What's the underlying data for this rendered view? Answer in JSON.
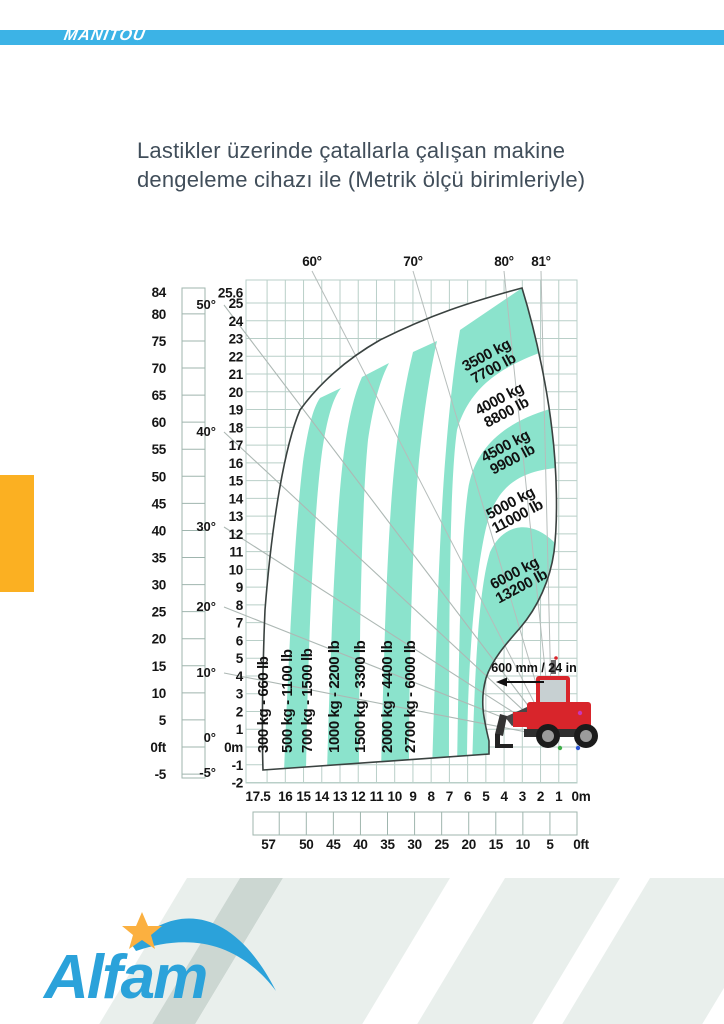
{
  "header": {
    "brand": "MANITOU",
    "bar_color": "#3cb3e6"
  },
  "title": {
    "line1": "Lastikler üzerinde çatallarla çalışan makine",
    "line2": "dengeleme cihazı ile (Metrik ölçü birimleriyle)"
  },
  "chart_data": {
    "type": "load-envelope-chart",
    "top_angle_labels": [
      "60°",
      "70°",
      "80°",
      "81°"
    ],
    "left_axis_ft": {
      "unit": "ft",
      "labels": [
        "84",
        "80",
        "75",
        "70",
        "65",
        "60",
        "55",
        "50",
        "45",
        "40",
        "35",
        "30",
        "25",
        "20",
        "15",
        "10",
        "5",
        "0ft",
        "-5"
      ]
    },
    "left_axis_angle": {
      "labels": [
        "50°",
        "40°",
        "30°",
        "20°",
        "10°",
        "0°",
        "-5°"
      ]
    },
    "left_axis_m": {
      "unit": "m",
      "labels": [
        "25.6",
        "25",
        "24",
        "23",
        "22",
        "21",
        "20",
        "19",
        "18",
        "17",
        "16",
        "15",
        "14",
        "13",
        "12",
        "11",
        "10",
        "9",
        "8",
        "7",
        "6",
        "5",
        "4",
        "3",
        "2",
        "1",
        "0m",
        "-1",
        "-2"
      ]
    },
    "x_axis_m": {
      "labels": [
        "17.5",
        "16",
        "15",
        "14",
        "13",
        "12",
        "11",
        "10",
        "9",
        "8",
        "7",
        "6",
        "5",
        "4",
        "3",
        "2",
        "1",
        "0m"
      ]
    },
    "x_axis_ft": {
      "labels": [
        "57",
        "50",
        "45",
        "40",
        "35",
        "30",
        "25",
        "20",
        "15",
        "10",
        "5",
        "0ft"
      ]
    },
    "load_zones_vertical": [
      {
        "kg": 300,
        "lb": 660,
        "label": "300 kg - 660 lb"
      },
      {
        "kg": 500,
        "lb": 1100,
        "label": "500 kg - 1100 lb"
      },
      {
        "kg": 700,
        "lb": 1500,
        "label": "700 kg - 1500 lb"
      },
      {
        "kg": 1000,
        "lb": 2200,
        "label": "1000 kg - 2200 lb"
      },
      {
        "kg": 1500,
        "lb": 3300,
        "label": "1500 kg - 3300 lb"
      },
      {
        "kg": 2000,
        "lb": 4400,
        "label": "2000 kg - 4400 lb"
      },
      {
        "kg": 2700,
        "lb": 6000,
        "label": "2700 kg - 6000 lb"
      }
    ],
    "load_zones_rotated": [
      {
        "kg": 3500,
        "lb": 7700,
        "line1": "3500 kg",
        "line2": "7700 lb"
      },
      {
        "kg": 4000,
        "lb": 8800,
        "line1": "4000 kg",
        "line2": "8800 lb"
      },
      {
        "kg": 4500,
        "lb": 9900,
        "line1": "4500 kg",
        "line2": "9900 lb"
      },
      {
        "kg": 5000,
        "lb": 11000,
        "line1": "5000 kg",
        "line2": "11000 lb"
      },
      {
        "kg": 6000,
        "lb": 13200,
        "line1": "6000 kg",
        "line2": "13200 lb"
      }
    ],
    "machine_clearance_label": "600 mm / 24 in",
    "colors": {
      "zone_teal": "#8be3cc",
      "grid": "#b9cfc8",
      "outline": "#3a4240"
    }
  },
  "footer": {
    "brand": "Alfam"
  }
}
